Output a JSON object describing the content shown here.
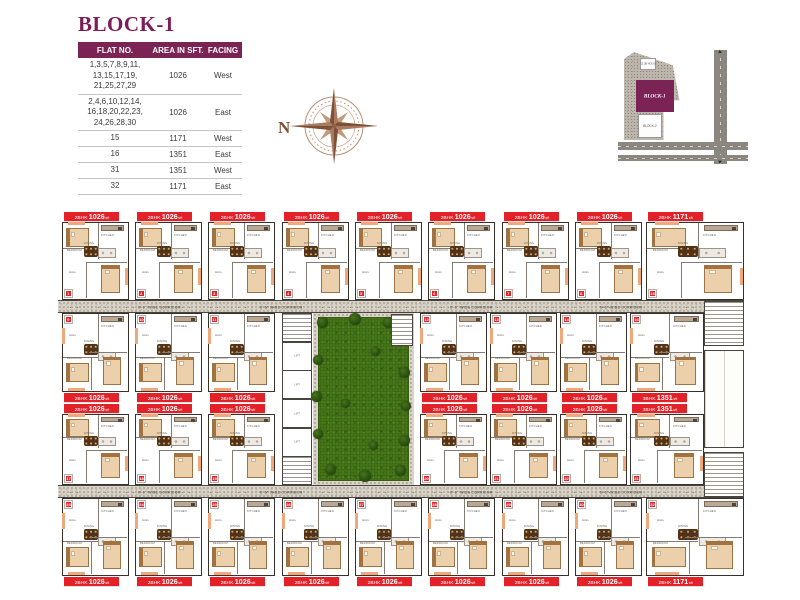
{
  "header": {
    "title": "BLOCK-1",
    "table": {
      "columns": [
        "FLAT NO.",
        "AREA IN SFT.",
        "FACING"
      ],
      "rows": [
        {
          "flat": [
            "1,3,5,7,8,9,11,",
            "13,15,17,19,",
            "21,25,27,29"
          ],
          "area": "1026",
          "facing": "West"
        },
        {
          "flat": [
            "2,4,6,10,12,14,",
            "16,18,20,22,23,",
            "24,26,28,30"
          ],
          "area": "1026",
          "facing": "East"
        },
        {
          "flat": [
            "15"
          ],
          "area": "1171",
          "facing": "West"
        },
        {
          "flat": [
            "16"
          ],
          "area": "1351",
          "facing": "East"
        },
        {
          "flat": [
            "31"
          ],
          "area": "1351",
          "facing": "West"
        },
        {
          "flat": [
            "32"
          ],
          "area": "1171",
          "facing": "East"
        }
      ]
    },
    "compass": {
      "label": "N",
      "color": "#a87a5f"
    },
    "keyplan": {
      "block1_label": "BLOCK-1",
      "block2_label": "BLOCK-2",
      "clubhouse_label": "CLUB HOUSE",
      "accent": "#7b2355"
    }
  },
  "plan": {
    "corridor_label": "6'-6\" WIDE CORRIDOR",
    "area_unit": "sft",
    "room_labels": {
      "bedroom": "BEDROOM",
      "kitchen": "KITCHEN",
      "dining": "DINING",
      "hall": "HALL",
      "lift": "LIFT"
    },
    "colors": {
      "label_red": "#e32128",
      "grass": "#467519",
      "wall": "#37312c",
      "purple": "#7b2355"
    },
    "corridors": [
      {
        "x": 58,
        "y": 300,
        "w": 686,
        "h": 13
      },
      {
        "x": 58,
        "y": 485,
        "w": 686,
        "h": 13
      }
    ],
    "corridor_label_xs": [
      138,
      260,
      450,
      600
    ],
    "courtyard": {
      "x": 313,
      "y": 313,
      "w": 101,
      "h": 172
    },
    "bushes": [
      {
        "x": 4,
        "y": 4,
        "s": 11
      },
      {
        "x": 36,
        "y": 0,
        "s": 12
      },
      {
        "x": 70,
        "y": 4,
        "s": 11
      },
      {
        "x": 88,
        "y": 22,
        "s": 10
      },
      {
        "x": 86,
        "y": 54,
        "s": 11
      },
      {
        "x": 88,
        "y": 88,
        "s": 10
      },
      {
        "x": 86,
        "y": 122,
        "s": 11
      },
      {
        "x": 82,
        "y": 152,
        "s": 11
      },
      {
        "x": 46,
        "y": 157,
        "s": 12
      },
      {
        "x": 12,
        "y": 151,
        "s": 11
      },
      {
        "x": 0,
        "y": 116,
        "s": 10
      },
      {
        "x": -2,
        "y": 78,
        "s": 11
      },
      {
        "x": 0,
        "y": 42,
        "s": 10
      },
      {
        "x": 28,
        "y": 86,
        "s": 9
      },
      {
        "x": 58,
        "y": 34,
        "s": 9
      },
      {
        "x": 56,
        "y": 128,
        "s": 9
      }
    ],
    "lift_column": {
      "x": 282,
      "y": 313,
      "w": 30,
      "h": 172,
      "cells": [
        "stair",
        "lift",
        "lift",
        "lift",
        "lift",
        "stair"
      ]
    },
    "side_blocks": [
      {
        "x": 704,
        "y": 301,
        "w": 40,
        "h": 45,
        "kind": "stair"
      },
      {
        "x": 704,
        "y": 350,
        "w": 40,
        "h": 98,
        "kind": "room"
      },
      {
        "x": 704,
        "y": 452,
        "w": 40,
        "h": 45,
        "kind": "stair"
      },
      {
        "x": 391,
        "y": 314,
        "w": 22,
        "h": 32,
        "kind": "stair"
      }
    ],
    "units": [
      {
        "x": 62,
        "y": 222,
        "w": 67,
        "h": 78,
        "bhk": "2BHK",
        "area": "1026",
        "n": "1",
        "door": "bottom"
      },
      {
        "x": 135,
        "y": 222,
        "w": 67,
        "h": 78,
        "bhk": "2BHK",
        "area": "1026",
        "n": "2",
        "door": "bottom"
      },
      {
        "x": 208,
        "y": 222,
        "w": 67,
        "h": 78,
        "bhk": "2BHK",
        "area": "1026",
        "n": "3",
        "door": "bottom"
      },
      {
        "x": 282,
        "y": 222,
        "w": 67,
        "h": 78,
        "bhk": "2BHK",
        "area": "1026",
        "n": "4",
        "door": "bottom"
      },
      {
        "x": 355,
        "y": 222,
        "w": 67,
        "h": 78,
        "bhk": "2BHK",
        "area": "1026",
        "n": "5",
        "door": "bottom"
      },
      {
        "x": 428,
        "y": 222,
        "w": 67,
        "h": 78,
        "bhk": "2BHK",
        "area": "1026",
        "n": "6",
        "door": "bottom"
      },
      {
        "x": 502,
        "y": 222,
        "w": 67,
        "h": 78,
        "bhk": "2BHK",
        "area": "1026",
        "n": "7",
        "door": "bottom"
      },
      {
        "x": 575,
        "y": 222,
        "w": 67,
        "h": 78,
        "bhk": "2BHK",
        "area": "1026",
        "n": "8",
        "door": "bottom"
      },
      {
        "x": 646,
        "y": 222,
        "w": 98,
        "h": 78,
        "bhk": "2BHK",
        "area": "1171",
        "n": "15",
        "door": "bottom"
      },
      {
        "x": 62,
        "y": 313,
        "w": 67,
        "h": 79,
        "bhk": "2BHK",
        "area": "1026",
        "n": "9",
        "door": "top"
      },
      {
        "x": 135,
        "y": 313,
        "w": 67,
        "h": 79,
        "bhk": "2BHK",
        "area": "1026",
        "n": "10",
        "door": "top"
      },
      {
        "x": 208,
        "y": 313,
        "w": 67,
        "h": 79,
        "bhk": "2BHK",
        "area": "1026",
        "n": "11",
        "door": "top"
      },
      {
        "x": 420,
        "y": 313,
        "w": 67,
        "h": 79,
        "bhk": "2BHK",
        "area": "1026",
        "n": "12",
        "door": "top"
      },
      {
        "x": 490,
        "y": 313,
        "w": 67,
        "h": 79,
        "bhk": "2BHK",
        "area": "1026",
        "n": "13",
        "door": "top"
      },
      {
        "x": 560,
        "y": 313,
        "w": 67,
        "h": 79,
        "bhk": "2BHK",
        "area": "1026",
        "n": "14",
        "door": "top"
      },
      {
        "x": 630,
        "y": 313,
        "w": 74,
        "h": 79,
        "bhk": "3BHK",
        "area": "1351",
        "n": "16",
        "door": "top"
      },
      {
        "x": 62,
        "y": 414,
        "w": 67,
        "h": 71,
        "bhk": "2BHK",
        "area": "1026",
        "n": "17",
        "door": "bottom"
      },
      {
        "x": 135,
        "y": 414,
        "w": 67,
        "h": 71,
        "bhk": "2BHK",
        "area": "1026",
        "n": "18",
        "door": "bottom"
      },
      {
        "x": 208,
        "y": 414,
        "w": 67,
        "h": 71,
        "bhk": "2BHK",
        "area": "1026",
        "n": "19",
        "door": "bottom"
      },
      {
        "x": 420,
        "y": 414,
        "w": 67,
        "h": 71,
        "bhk": "2BHK",
        "area": "1026",
        "n": "20",
        "door": "bottom"
      },
      {
        "x": 490,
        "y": 414,
        "w": 67,
        "h": 71,
        "bhk": "2BHK",
        "area": "1026",
        "n": "21",
        "door": "bottom"
      },
      {
        "x": 560,
        "y": 414,
        "w": 67,
        "h": 71,
        "bhk": "2BHK",
        "area": "1026",
        "n": "22",
        "door": "bottom"
      },
      {
        "x": 630,
        "y": 414,
        "w": 74,
        "h": 71,
        "bhk": "3BHK",
        "area": "1351",
        "n": "31",
        "door": "bottom"
      },
      {
        "x": 62,
        "y": 498,
        "w": 67,
        "h": 78,
        "bhk": "2BHK",
        "area": "1026",
        "n": "23",
        "door": "top"
      },
      {
        "x": 135,
        "y": 498,
        "w": 67,
        "h": 78,
        "bhk": "2BHK",
        "area": "1026",
        "n": "24",
        "door": "top"
      },
      {
        "x": 208,
        "y": 498,
        "w": 67,
        "h": 78,
        "bhk": "2BHK",
        "area": "1026",
        "n": "25",
        "door": "top"
      },
      {
        "x": 282,
        "y": 498,
        "w": 67,
        "h": 78,
        "bhk": "2BHK",
        "area": "1026",
        "n": "26",
        "door": "top"
      },
      {
        "x": 355,
        "y": 498,
        "w": 67,
        "h": 78,
        "bhk": "2BHK",
        "area": "1026",
        "n": "27",
        "door": "top"
      },
      {
        "x": 428,
        "y": 498,
        "w": 67,
        "h": 78,
        "bhk": "2BHK",
        "area": "1026",
        "n": "28",
        "door": "top"
      },
      {
        "x": 502,
        "y": 498,
        "w": 67,
        "h": 78,
        "bhk": "2BHK",
        "area": "1026",
        "n": "29",
        "door": "top"
      },
      {
        "x": 575,
        "y": 498,
        "w": 67,
        "h": 78,
        "bhk": "2BHK",
        "area": "1026",
        "n": "30",
        "door": "top"
      },
      {
        "x": 646,
        "y": 498,
        "w": 98,
        "h": 78,
        "bhk": "2BHK",
        "area": "1171",
        "n": "32",
        "door": "top"
      }
    ]
  }
}
